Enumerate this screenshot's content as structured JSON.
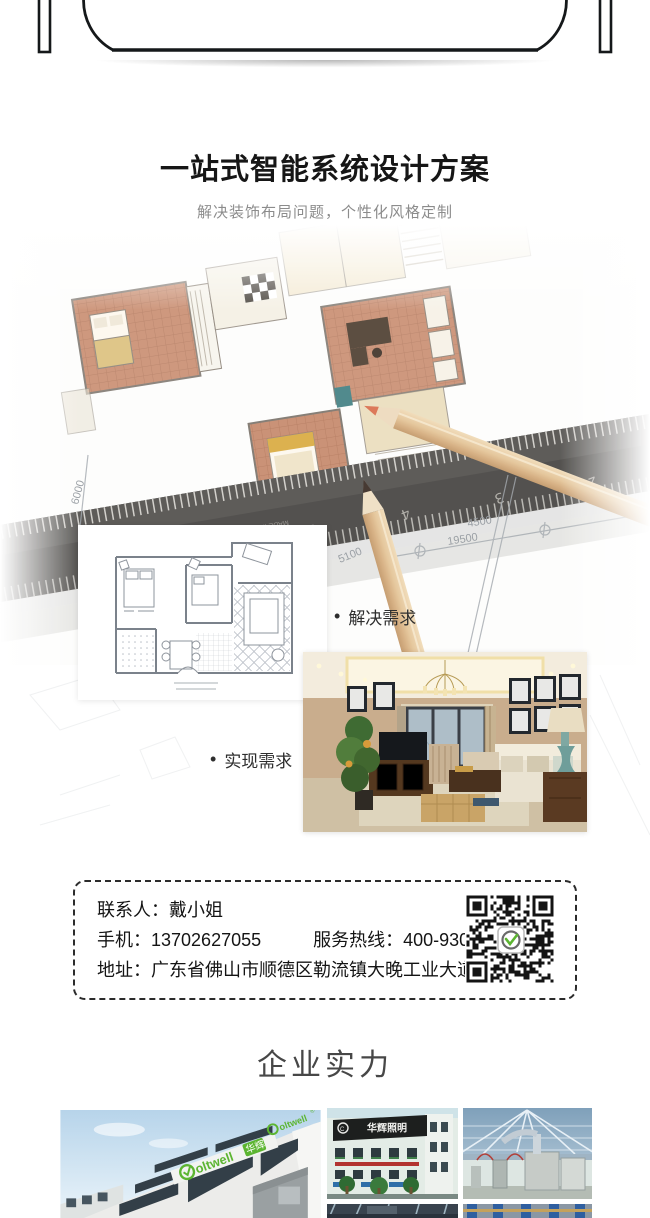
{
  "solution": {
    "title": "一站式智能系统设计方案",
    "subtitle": "解决装饰布局问题，个性化风格定制",
    "bullet_marker": "•",
    "bullet_solve": "解决需求",
    "bullet_realize": "实现需求",
    "dims": {
      "a": "4500",
      "b": "19500",
      "c": "5100",
      "d": "6000"
    },
    "ruler": {
      "numbers": [
        "7",
        "6",
        "5",
        "4",
        "3",
        "2"
      ],
      "brand": "STAINLESS",
      "origin": "MADE IN CHINA"
    }
  },
  "contact": {
    "person_label": "联系人：",
    "person": "戴小姐",
    "mobile_label": "手机：",
    "mobile": "13702627055",
    "hotline_label": "服务热线：",
    "hotline": "400-930-3600",
    "address_label": "地址：",
    "address": "广东省佛山市顺德区勒流镇大晚工业大道3号"
  },
  "strength": {
    "heading": "企业实力"
  },
  "gallery": {
    "coltwell_text": "oltwell",
    "coltwell_cn": "华辉",
    "coltwell_reg": "®",
    "sign_text": "华辉照明"
  },
  "colors": {
    "accent_green": "#5cb531",
    "title_dark": "#161616",
    "subtitle_gray": "#8c8c8c"
  }
}
